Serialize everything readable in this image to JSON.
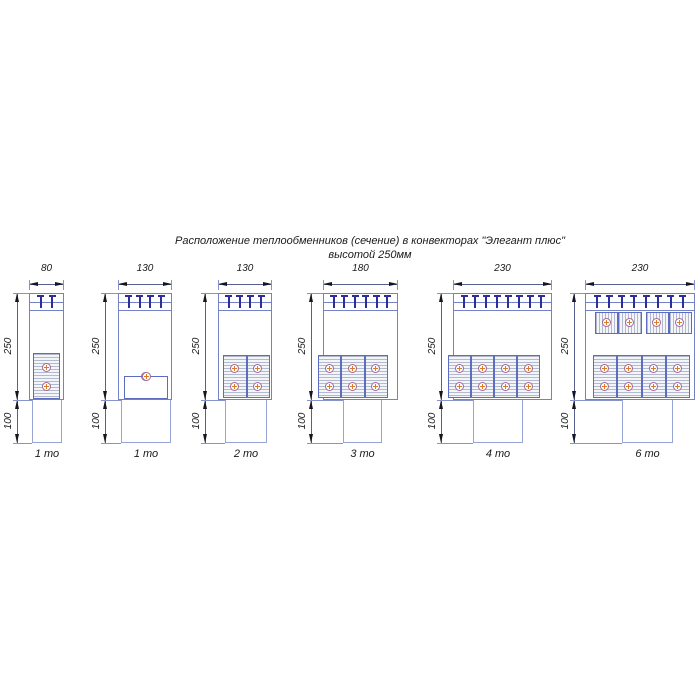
{
  "title": {
    "line1": "Расположение теплообменников (сечение) в конвекторах \"Элегант плюс\"",
    "line2": "высотой 250мм"
  },
  "convectors": [
    {
      "width_mm": "80",
      "height_mm": "250",
      "duct_height_mm": "100",
      "label": "1 то",
      "tmarks": 2,
      "rows": [
        {
          "orientation": "vertical",
          "units": 1,
          "circles_per_unit": 2
        }
      ]
    },
    {
      "width_mm": "130",
      "height_mm": "250",
      "duct_height_mm": "100",
      "label": "1 то",
      "tmarks": 4,
      "rows": [
        {
          "orientation": "horizontal",
          "units": 1,
          "circles_per_unit": 2
        }
      ]
    },
    {
      "width_mm": "130",
      "height_mm": "250",
      "duct_height_mm": "100",
      "label": "2 то",
      "tmarks": 4,
      "rows": [
        {
          "orientation": "vertical",
          "units": 2,
          "circles_per_unit": 2
        }
      ]
    },
    {
      "width_mm": "180",
      "height_mm": "250",
      "duct_height_mm": "100",
      "label": "3 то",
      "tmarks": 6,
      "rows": [
        {
          "orientation": "vertical",
          "units": 3,
          "circles_per_unit": 2
        }
      ]
    },
    {
      "width_mm": "230",
      "height_mm": "250",
      "duct_height_mm": "100",
      "label": "4 то",
      "tmarks": 8,
      "rows": [
        {
          "orientation": "vertical",
          "units": 4,
          "circles_per_unit": 2
        }
      ]
    },
    {
      "width_mm": "230",
      "height_mm": "250",
      "duct_height_mm": "100",
      "label": "6 то",
      "tmarks": 8,
      "rows": [
        {
          "orientation": "horizontal",
          "units": 2,
          "circles_per_unit": 2
        },
        {
          "orientation": "vertical",
          "units": 4,
          "circles_per_unit": 2
        }
      ]
    }
  ],
  "colors": {
    "outline_blue": "#7381c6",
    "block_blue": "#5c6cc0",
    "grille_navy": "#2b2f9e",
    "tube_purple": "#9c6a9e",
    "tube_cross_orange": "#dd7a28",
    "dim_line": "#55608f",
    "extension_line": "#8892cc",
    "hatch_gray": "#b4bace",
    "text": "#1a1a1a",
    "background": "#ffffff"
  }
}
